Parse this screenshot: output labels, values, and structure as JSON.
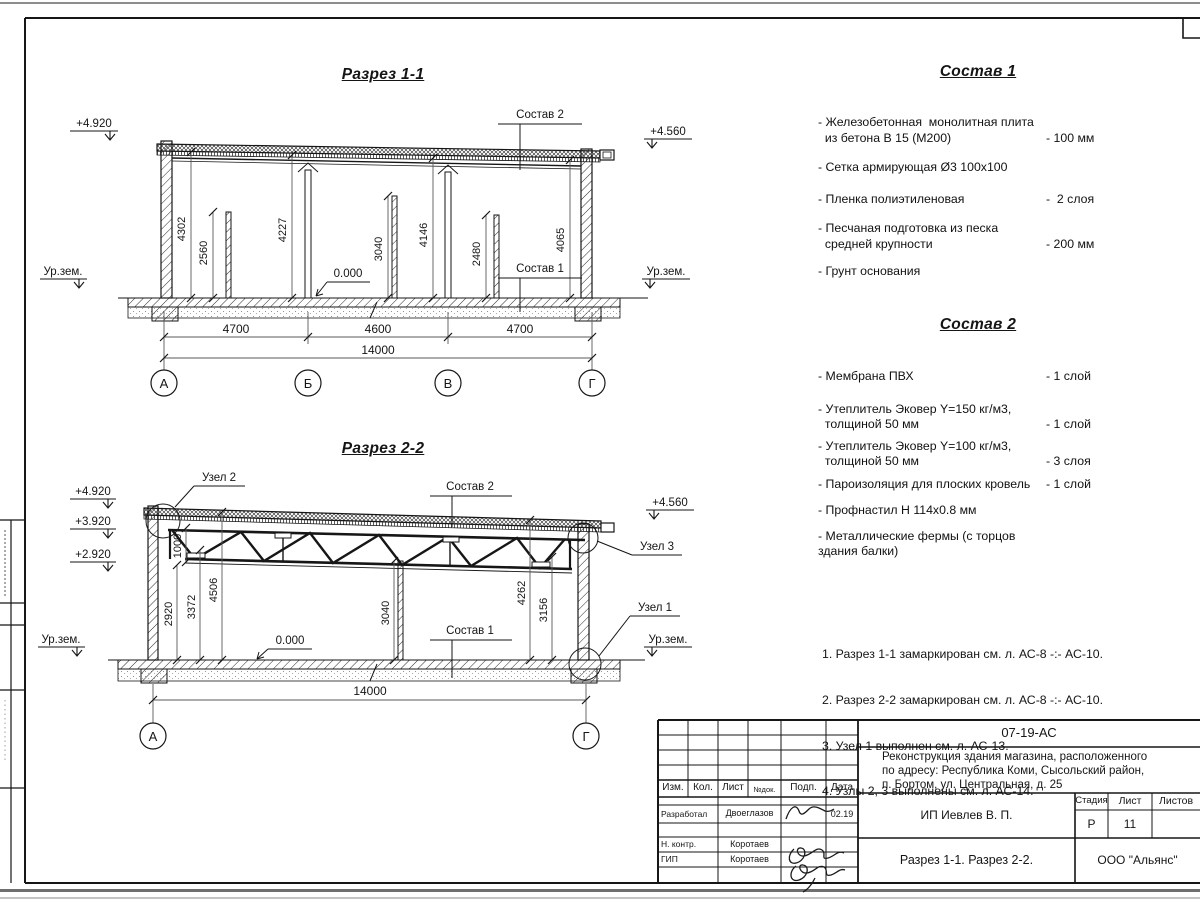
{
  "section1": {
    "title": "Разрез 1-1",
    "elev_left": "+4.920",
    "elev_right": "+4.560",
    "ground_left": "Ур.зем.",
    "ground_right": "Ур.зем.",
    "zero_mark": "0.000",
    "label_sostav2": "Состав 2",
    "label_sostav1": "Состав 1",
    "dims_vertical": [
      "4302",
      "2560",
      "4227",
      "3040",
      "4146",
      "2480",
      "4065"
    ],
    "dims_bottom": [
      "4700",
      "4600",
      "4700"
    ],
    "dim_total": "14000",
    "axes": [
      "А",
      "Б",
      "В",
      "Г"
    ]
  },
  "section2": {
    "title": "Разрез 2-2",
    "elevs_left": [
      "+4.920",
      "+3.920",
      "+2.920"
    ],
    "elev_right": "+4.560",
    "ground_left": "Ур.зем.",
    "ground_right": "Ур.зем.",
    "zero_mark": "0.000",
    "label_sostav2": "Состав 2",
    "label_sostav1": "Состав 1",
    "node2": "Узел 2",
    "node3": "Узел 3",
    "node1": "Узел 1",
    "dims_vertical": [
      "1000",
      "2920",
      "3372",
      "4506",
      "3040",
      "4262",
      "3156"
    ],
    "dim_total": "14000",
    "axes": [
      "А",
      "Г"
    ]
  },
  "sostav1": {
    "title": "Состав 1",
    "items": [
      {
        "text": "- Железобетонная  монолитная плита\n  из бетона В 15 (М200)",
        "value": "- 100 мм"
      },
      {
        "text": "- Сетка армирующая Ø3 100х100",
        "value": ""
      },
      {
        "text": "- Пленка полиэтиленовая",
        "value": "-  2 слоя"
      },
      {
        "text": "- Песчаная подготовка из песка\n  средней крупности",
        "value": "- 200 мм"
      },
      {
        "text": "- Грунт основания",
        "value": ""
      }
    ]
  },
  "sostav2": {
    "title": "Состав 2",
    "items": [
      {
        "text": "- Мембрана ПВХ",
        "value": "- 1 слой"
      },
      {
        "text": "- Утеплитель Эковер Y=150 кг/м3,\n  толщиной 50 мм",
        "value": "- 1 слой"
      },
      {
        "text": "- Утеплитель Эковер Y=100 кг/м3,\n  толщиной 50 мм",
        "value": "- 3 слоя"
      },
      {
        "text": "- Пароизоляция для плоских кровель",
        "value": "- 1 слой"
      },
      {
        "text": "- Профнастил Н 114х0.8 мм",
        "value": ""
      },
      {
        "text": "- Металлические фермы (с торцов здания балки)",
        "value": ""
      }
    ]
  },
  "notes": [
    "1. Разрез 1-1 замаркирован см. л. АС-8 -:- АС-10.",
    "2. Разрез 2-2 замаркирован см. л. АС-8 -:- АС-10.",
    "3. Узел 1 выполнен см. л. АС-13.",
    "4. Узлы 2, 3 выполнены см. л. АС-14."
  ],
  "titleblock": {
    "doc_code": "07-19-АС",
    "project": "Реконструкция здания магазина, расположенного\nпо адресу: Республика Коми, Сысольский район,\nп. Бортом, ул. Центральная, д. 25",
    "col_izm": "Изм.",
    "col_kol": "Кол.",
    "col_list": "Лист",
    "col_ndok": "№док.",
    "col_podp": "Подп.",
    "col_data": "Дата",
    "row1_role": "Разработал",
    "row1_name": "Двоеглазов",
    "row1_date": "02.19",
    "row2_role": "Н. контр.",
    "row2_name": "Коротаев",
    "row3_role": "ГИП",
    "row3_name": "Коротаев",
    "client": "ИП Иевлев В. П.",
    "stage_label": "Стадия",
    "sheet_label": "Лист",
    "sheets_label": "Листов",
    "stage": "Р",
    "sheet_no": "11",
    "drawing_title": "Разрез 1-1. Разрез 2-2.",
    "company": "ООО \"Альянс\""
  }
}
